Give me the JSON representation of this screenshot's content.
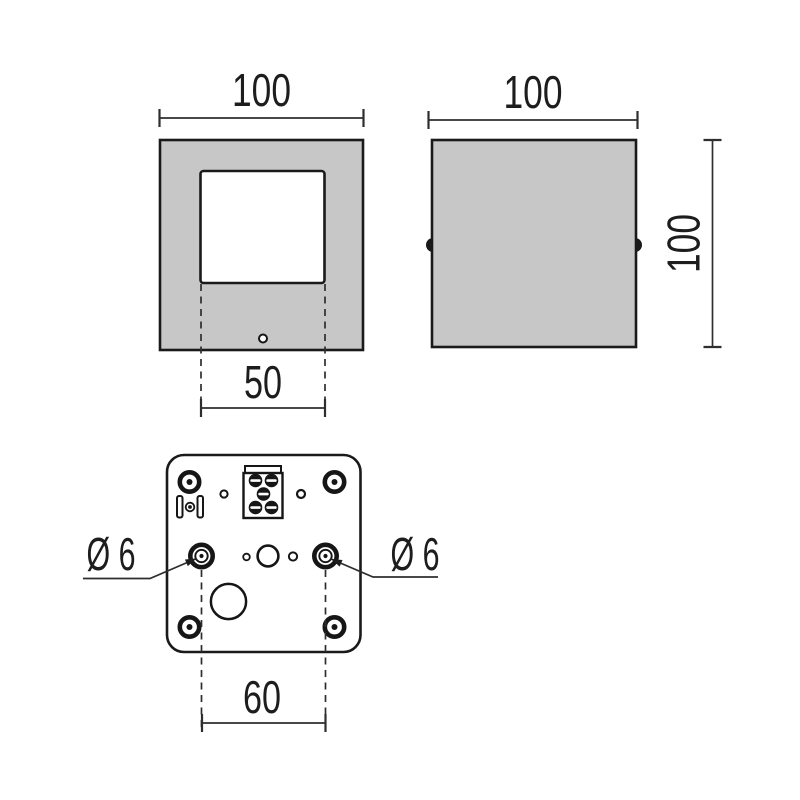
{
  "colors": {
    "background": "#ffffff",
    "body_fill": "#c7c7c7",
    "outline": "#1a1a1a",
    "dimension_line": "#2e2e2e",
    "text": "#1d1d1d"
  },
  "views": {
    "front": {
      "top_dimension": "100",
      "window_dimension": "50"
    },
    "side": {
      "top_dimension": "100",
      "right_dimension": "100"
    },
    "base": {
      "hole_spacing_dimension": "60",
      "left_hole_diameter": "Ø 6",
      "right_hole_diameter": "Ø 6"
    }
  }
}
